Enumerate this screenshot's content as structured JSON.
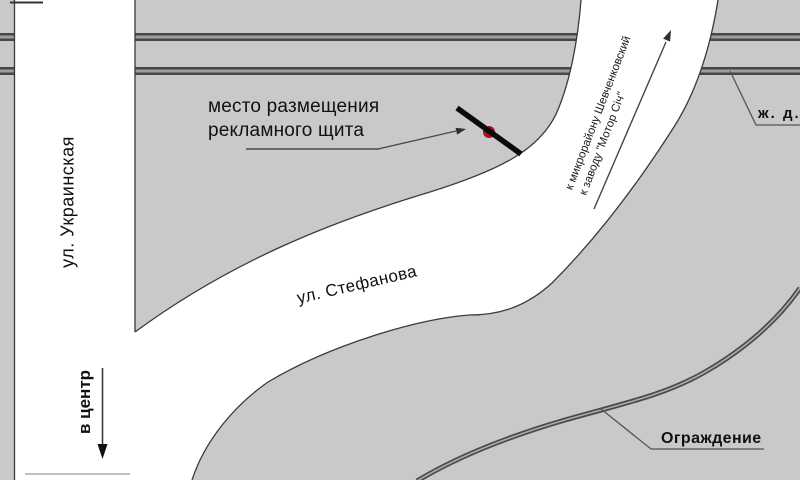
{
  "labels": {
    "billboard_line1": "место размещения",
    "billboard_line2": "рекламного щита",
    "street_vertical": "ул. Украинская",
    "street_curved": "ул. Стефанова",
    "direction_to_center": "в центр",
    "direction_road_line1": "к микрорайону Шевченковский",
    "direction_road_line2": "к заводу \"Мотор Січ\"",
    "railroad_abbrev": "ж. д.",
    "fence": "Ограждение"
  },
  "colors": {
    "background": "#c9c9c9",
    "road_fill": "#ffffff",
    "outline": "#3a3a3a",
    "railway_dark": "#474747",
    "railway_light": "#9e9e9e",
    "fence_dark": "#4a4a4a",
    "fence_light": "#ababab",
    "marker_red": "#a8101f",
    "marker_black": "#0a0a0a",
    "text": "#111111"
  }
}
